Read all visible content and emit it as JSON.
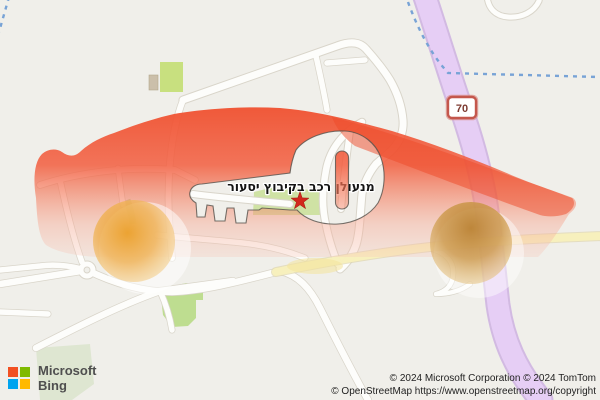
{
  "map": {
    "place_label": "מנעולן רכב בקיבוץ יסעור",
    "route_shield": "70"
  },
  "branding": {
    "line1": "Microsoft",
    "line2": "Bing"
  },
  "attribution": {
    "line1": "© 2024 Microsoft Corporation © 2024 TomTom",
    "line2": "© OpenStreetMap https://www.openstreetmap.org/copyright"
  },
  "colors": {
    "background": "#f0efea",
    "road_fill": "#fdfdfb",
    "road_casing": "#d9d5ca",
    "overlay_red": "#f0502f",
    "wheel_orange_left": "#eca42f",
    "wheel_brown_right": "#bf8334",
    "route_purple": "#e6cdf5",
    "route_yellow": "#f8f0bd",
    "stream_blue": "#78a3d6",
    "park_green": "#c8e07f",
    "marker_red": "#d2281c",
    "shield_border": "#c4574c"
  }
}
